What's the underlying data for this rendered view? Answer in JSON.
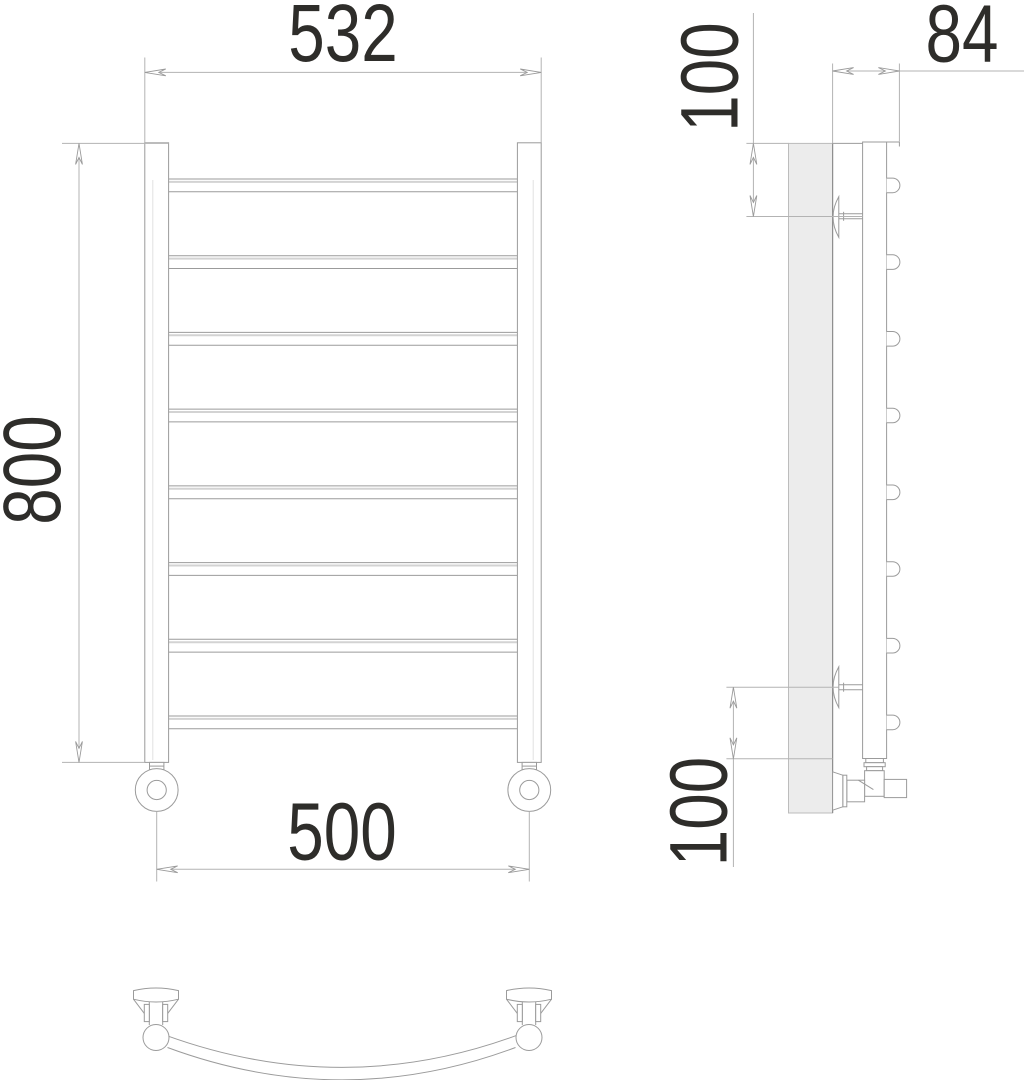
{
  "drawing": {
    "subject": "Curved heated towel rail — orthographic technical drawing",
    "views": {
      "front": "front view",
      "side": "side view",
      "plan": "bottom plan view of curved crossbar"
    },
    "structure": {
      "crossbar_count": 8,
      "post_count": 2,
      "wall_bracket_count": 2
    },
    "labels": {
      "overall_width": "532",
      "height": "800",
      "mount_spacing": "500",
      "depth": "84",
      "top_offset": "100",
      "bottom_offset": "100"
    },
    "colors": {
      "object_line": "#9b9b9b",
      "dimension_line": "#b3b3b3",
      "highlight_line": "#d3d3d3",
      "wall_fill": "#ececec",
      "label_text": "#2e2d2a",
      "background": "#ffffff"
    }
  }
}
